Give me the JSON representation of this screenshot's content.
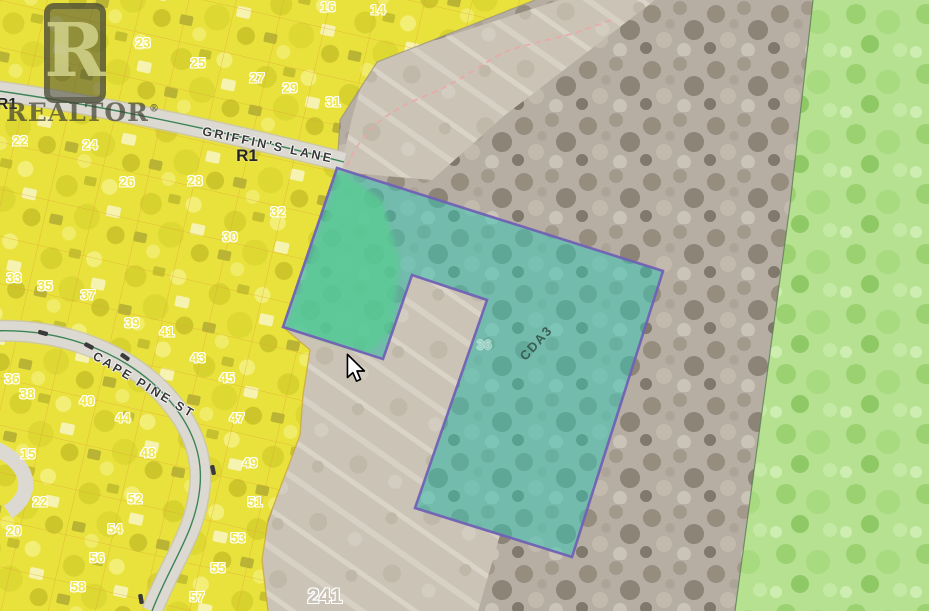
{
  "map_view": {
    "watermark": {
      "letter": "R",
      "text": "REALTOR",
      "reg": "®"
    },
    "zoning_labels": [
      {
        "text": "R1",
        "x": 7,
        "y": 105,
        "size": 16
      },
      {
        "text": "R1",
        "x": 247,
        "y": 156,
        "size": 17
      },
      {
        "text": "CDA3",
        "x": 536,
        "y": 343,
        "rotate": -48,
        "cls": "cda"
      }
    ],
    "street_labels": [
      {
        "text": "GRIFFIN'S LANE",
        "x": 268,
        "y": 145,
        "rotate": 12
      },
      {
        "text": "CAPE PINE ST",
        "x": 144,
        "y": 385,
        "rotate": 31
      }
    ],
    "lot_labels": [
      {
        "text": "16",
        "x": 328,
        "y": 7
      },
      {
        "text": "14",
        "x": 378,
        "y": 10
      },
      {
        "text": "23",
        "x": 143,
        "y": 43
      },
      {
        "text": "25",
        "x": 198,
        "y": 63
      },
      {
        "text": "27",
        "x": 257,
        "y": 78
      },
      {
        "text": "29",
        "x": 290,
        "y": 88
      },
      {
        "text": "31",
        "x": 333,
        "y": 102
      },
      {
        "text": "22",
        "x": 20,
        "y": 141
      },
      {
        "text": "24",
        "x": 90,
        "y": 145
      },
      {
        "text": "26",
        "x": 127,
        "y": 182
      },
      {
        "text": "28",
        "x": 195,
        "y": 181
      },
      {
        "text": "32",
        "x": 278,
        "y": 212
      },
      {
        "text": "30",
        "x": 230,
        "y": 237
      },
      {
        "text": "33",
        "x": 14,
        "y": 278
      },
      {
        "text": "35",
        "x": 45,
        "y": 286
      },
      {
        "text": "37",
        "x": 88,
        "y": 295
      },
      {
        "text": "39",
        "x": 132,
        "y": 323
      },
      {
        "text": "41",
        "x": 167,
        "y": 332
      },
      {
        "text": "43",
        "x": 198,
        "y": 358
      },
      {
        "text": "45",
        "x": 227,
        "y": 378
      },
      {
        "text": "36",
        "x": 12,
        "y": 379
      },
      {
        "text": "38",
        "x": 27,
        "y": 394
      },
      {
        "text": "40",
        "x": 87,
        "y": 401
      },
      {
        "text": "44",
        "x": 123,
        "y": 418
      },
      {
        "text": "47",
        "x": 237,
        "y": 418
      },
      {
        "text": "15",
        "x": 28,
        "y": 454
      },
      {
        "text": "48",
        "x": 148,
        "y": 453
      },
      {
        "text": "49",
        "x": 250,
        "y": 463
      },
      {
        "text": "22",
        "x": 40,
        "y": 502
      },
      {
        "text": "52",
        "x": 135,
        "y": 499
      },
      {
        "text": "51",
        "x": 255,
        "y": 502
      },
      {
        "text": "20",
        "x": 14,
        "y": 531
      },
      {
        "text": "54",
        "x": 115,
        "y": 529
      },
      {
        "text": "53",
        "x": 238,
        "y": 538
      },
      {
        "text": "56",
        "x": 97,
        "y": 558
      },
      {
        "text": "55",
        "x": 218,
        "y": 568
      },
      {
        "text": "58",
        "x": 78,
        "y": 587
      },
      {
        "text": "57",
        "x": 197,
        "y": 597
      },
      {
        "text": "36",
        "x": 484,
        "y": 345,
        "cls": "ghost"
      }
    ],
    "area_labels": [
      {
        "text": "241",
        "x": 325,
        "y": 597,
        "cls": "big"
      }
    ],
    "legend_colors": {
      "residential_yellow": "#e9e23c",
      "parcel_teal": "#7fd8cc",
      "parcel_border_purple": "#7161b5",
      "greenspace_green": "#b6e191",
      "road_gray": "#dcd9d2",
      "centerline_green": "#2a7a4a",
      "trail_pink": "#eba6a6"
    }
  }
}
